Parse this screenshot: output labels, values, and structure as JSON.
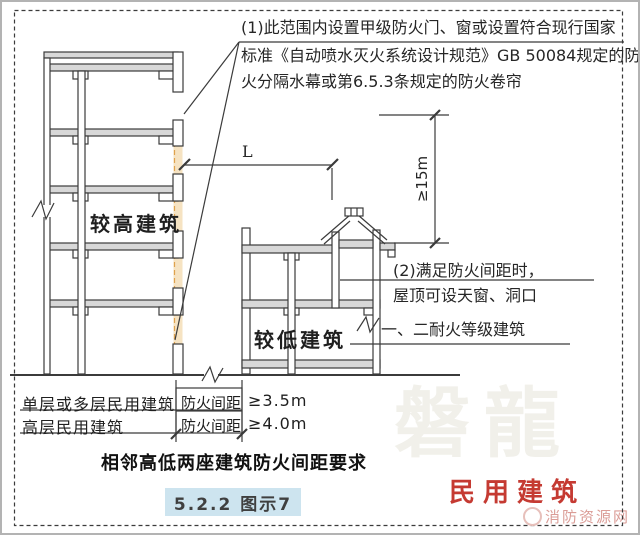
{
  "notes": {
    "note1_lines": [
      "(1)此范围内设置甲级防火门、窗或设置符合现行国家",
      "标准《自动喷水灭火系统设计规范》GB 50084规定的防",
      "火分隔水幕或第6.5.3条规定的防火卷帘"
    ],
    "note2_lines": [
      "(2)满足防火间距时，",
      "屋顶可设天窗、洞口"
    ],
    "fire_resistance_label": "一、二耐火等级建筑"
  },
  "buildings": {
    "taller_label": "较高建筑",
    "lower_label": "较低建筑"
  },
  "dimensions": {
    "distance_label": "L",
    "height_label": "≥15m"
  },
  "table": {
    "rows": [
      {
        "building_type": "单层或多层民用建筑",
        "distance_type": "防火间距",
        "value": "≥3.5m"
      },
      {
        "building_type": "高层民用建筑",
        "distance_type": "防火间距",
        "value": "≥4.0m"
      }
    ],
    "caption": "相邻高低两座建筑防火间距要求"
  },
  "footer": {
    "figure_ref": "5.2.2 图示7",
    "category_label": "民用建筑",
    "site_name": "消防资源网"
  },
  "watermark": {
    "text": "磐龍"
  },
  "colors": {
    "highlight_zone": "#f6e3c2",
    "highlight_dash": "#dfa24d",
    "figure_ref_bg": "#cde4ef",
    "category_red": "#c53a32",
    "site_pink": "#db9d97",
    "watermark_gray": "#f1f0ea",
    "line": "#3b3b3b"
  }
}
